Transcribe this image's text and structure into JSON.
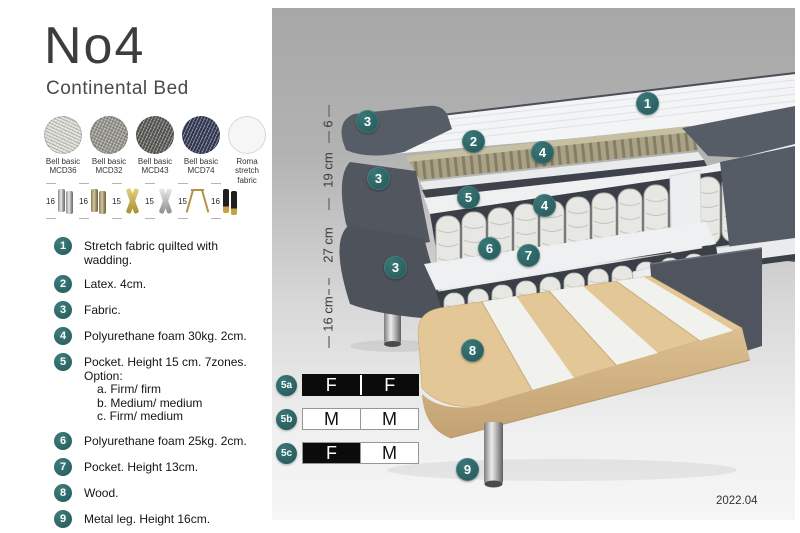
{
  "header": {
    "title": "No4",
    "subtitle": "Continental Bed"
  },
  "fabrics": [
    {
      "line1": "Bell basic",
      "line2": "MCD36"
    },
    {
      "line1": "Bell basic",
      "line2": "MCD32"
    },
    {
      "line1": "Bell basic",
      "line2": "MCD43"
    },
    {
      "line1": "Bell basic",
      "line2": "MCD74"
    },
    {
      "line1": "Roma",
      "line2": "stretch fabric"
    }
  ],
  "legs": [
    {
      "height": "16"
    },
    {
      "height": "16"
    },
    {
      "height": "15"
    },
    {
      "height": "15"
    },
    {
      "height": "15"
    },
    {
      "height": "16"
    }
  ],
  "features": [
    {
      "num": "1",
      "text": "Stretch fabric quilted with wadding."
    },
    {
      "num": "2",
      "text": "Latex. 4cm."
    },
    {
      "num": "3",
      "text": "Fabric."
    },
    {
      "num": "4",
      "text": "Polyurethane foam 30kg. 2cm."
    },
    {
      "num": "5",
      "text": "Pocket. Height 15 cm. 7zones. Option:",
      "sub": [
        "a. Firm/ firm",
        "b. Medium/ medium",
        "c. Firm/ medium"
      ]
    },
    {
      "num": "6",
      "text": "Polyurethane foam 25kg. 2cm."
    },
    {
      "num": "7",
      "text": "Pocket. Height 13cm."
    },
    {
      "num": "8",
      "text": "Wood."
    },
    {
      "num": "9",
      "text": "Metal leg. Height 16cm."
    }
  ],
  "illustration": {
    "badges": [
      "1",
      "2",
      "3",
      "3",
      "3",
      "4",
      "4",
      "5",
      "6",
      "7",
      "8",
      "9"
    ],
    "dimensions": [
      "6",
      "19 cm",
      "27 cm",
      "16 cm"
    ]
  },
  "firmness": [
    {
      "id": "5a",
      "cells": [
        {
          "label": "F",
          "variant": "dark"
        },
        {
          "label": "F",
          "variant": "dark"
        }
      ]
    },
    {
      "id": "5b",
      "cells": [
        {
          "label": "M",
          "variant": "light"
        },
        {
          "label": "M",
          "variant": "light"
        }
      ]
    },
    {
      "id": "5c",
      "cells": [
        {
          "label": "F",
          "variant": "dark"
        },
        {
          "label": "M",
          "variant": "light"
        }
      ]
    }
  ],
  "footer": {
    "version": "2022.04"
  },
  "colors": {
    "accent_teal": "#2e6d6e",
    "upholstery_dark": "#555b65",
    "latex_khaki": "#a9a286",
    "wood": "#e4c797",
    "navy_fabric": "#343a58"
  }
}
